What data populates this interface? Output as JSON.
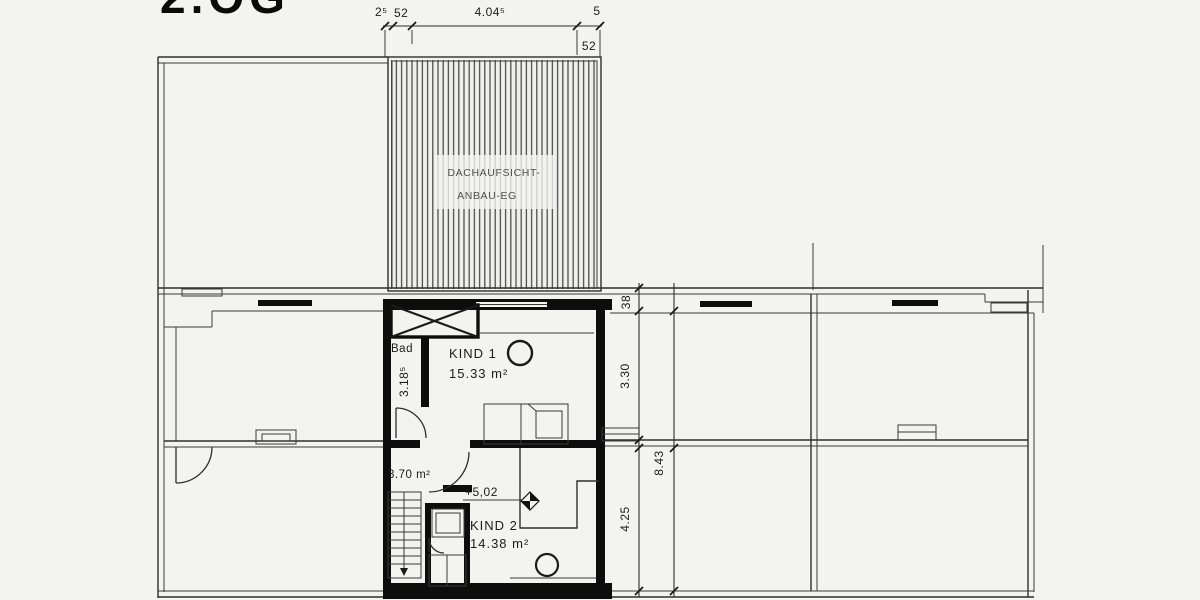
{
  "title": "2.OG",
  "roof": {
    "label1": "DACHAUFSICHT-",
    "label2": "ANBAU-EG"
  },
  "dims": {
    "top": {
      "t1": "2⁵",
      "t2": "52",
      "t3": "4.04⁵",
      "t4": "5",
      "t5": "52"
    },
    "right": {
      "wall": "38",
      "upper": "3.30",
      "total": "8.43",
      "lower": "4.25"
    },
    "bad_depth": "3.18⁵"
  },
  "rooms": {
    "bad": {
      "name": "Bad"
    },
    "kind1": {
      "name": "KIND 1",
      "area": "15.33 m²"
    },
    "hall": {
      "area": "3.70 m²"
    },
    "kind2": {
      "name": "KIND 2",
      "area": "14.38 m²",
      "level": "+5,02"
    }
  },
  "colors": {
    "background": "#f3f3f1",
    "line": "#2e2e2e",
    "wall": "#0d0d0d",
    "text": "#1c1c1c",
    "roof_text": "#4f4f4f"
  }
}
